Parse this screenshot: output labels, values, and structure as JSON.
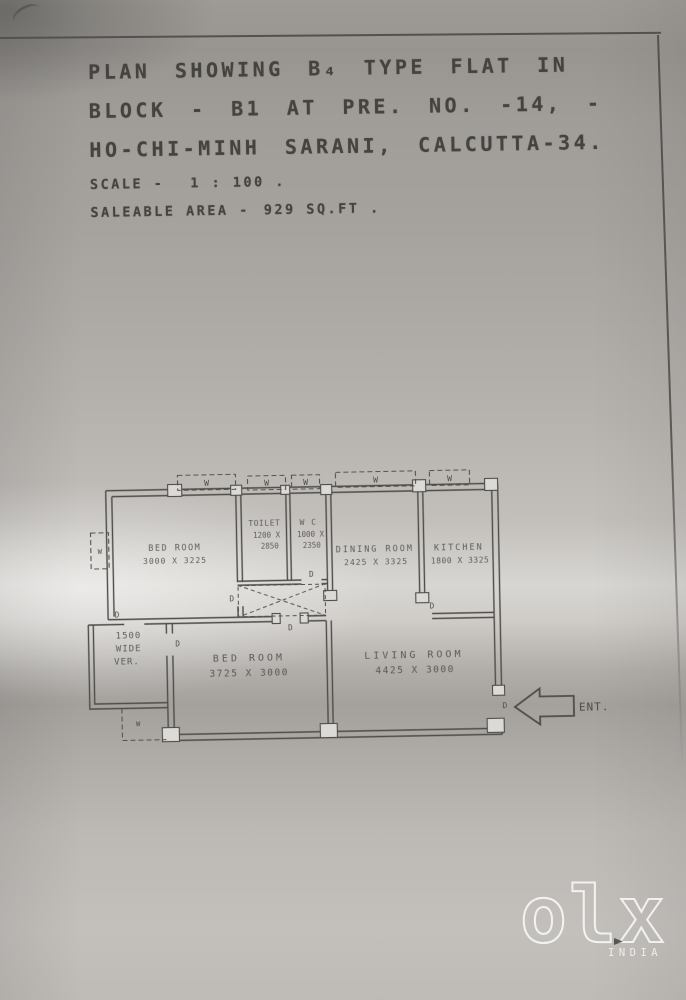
{
  "photo": {
    "paper_base_color": "#b2afaa",
    "ink_color": "#4e4d4a",
    "watermark_color": "#ffffff"
  },
  "header": {
    "title_line1": "PLAN SHOWING B₄ TYPE FLAT IN",
    "title_line2": "BLOCK - B1 AT PRE. NO. -14, -",
    "title_line3": "HO-CHI-MINH SARANI, CALCUTTA-34.",
    "scale_label": "SCALE -",
    "scale_value": "1 : 100 .",
    "area_label": "SALEABLE AREA -",
    "area_value": "929 SQ.FT ."
  },
  "plan": {
    "rooms": [
      {
        "name": "BED ROOM",
        "dims": "3000 X 3225"
      },
      {
        "name": "TOILET",
        "dims_line1": "1200 X",
        "dims_line2": "2850"
      },
      {
        "name": "W C",
        "dims_line1": "1000 X",
        "dims_line2": "2350"
      },
      {
        "name": "DINING ROOM",
        "dims": "2425 X 3325"
      },
      {
        "name": "KITCHEN",
        "dims": "1800 X 3325"
      },
      {
        "name": "BED ROOM",
        "dims": "3725 X 3000"
      },
      {
        "name": "LIVING ROOM",
        "dims": "4425 X 3000"
      }
    ],
    "verandah": {
      "line1": "1500",
      "line2": "WIDE",
      "line3": "VER."
    },
    "entrance_label": "ENT.",
    "window_label": "W",
    "door_label": "D"
  },
  "watermark": {
    "logo_text": "olx",
    "country_label": "INDIA"
  }
}
